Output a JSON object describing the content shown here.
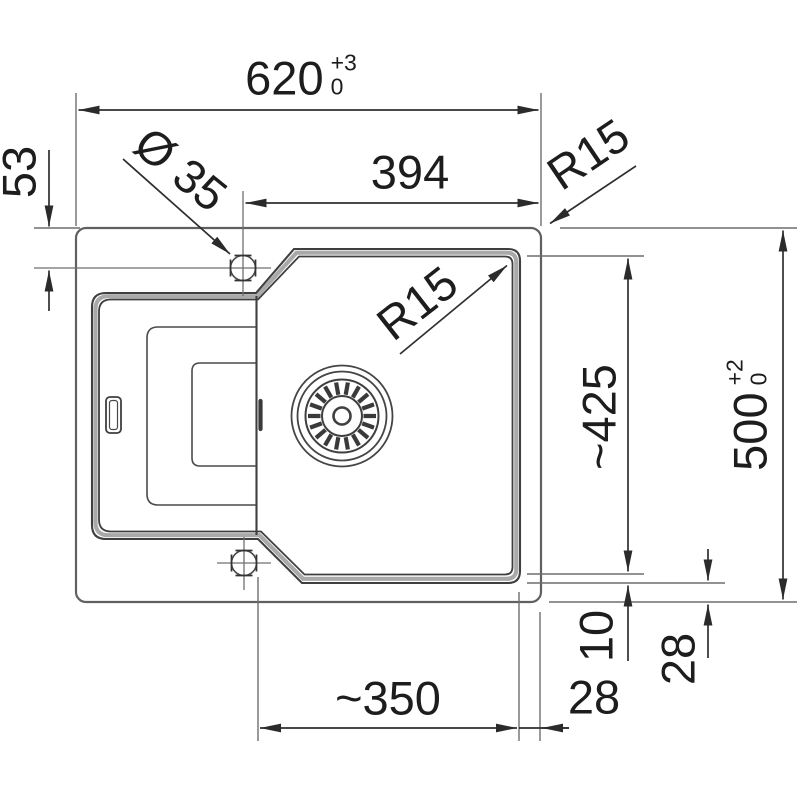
{
  "drawing": {
    "type": "sink-installation-dimension-drawing",
    "colors": {
      "outline": "#3f3f3f",
      "rim_band": "#a9a9a9",
      "dimension_line": "#2f2f2f",
      "extension_line": "#6f6f6f",
      "text": "#1d1d1d",
      "background": "#ffffff"
    },
    "labels": {
      "width_total": {
        "value": "620",
        "tol_plus": "+3",
        "tol_zero": "0"
      },
      "width_tap_to_edge": {
        "value": "394"
      },
      "tap_offset_top": {
        "value": "53"
      },
      "tap_hole_diameter": {
        "value": "Ø 35"
      },
      "corner_radius_outer": {
        "value": "R15"
      },
      "corner_radius_bowl": {
        "value": "R15"
      },
      "bowl_length": {
        "value": "~425"
      },
      "depth_total": {
        "value": "500",
        "tol_plus": "+2",
        "tol_zero": "0"
      },
      "rim_width": {
        "value": "10"
      },
      "edge_offset_right": {
        "value": "28"
      },
      "bowl_width": {
        "value": "~350"
      },
      "edge_offset_bottom": {
        "value": "28"
      }
    }
  }
}
